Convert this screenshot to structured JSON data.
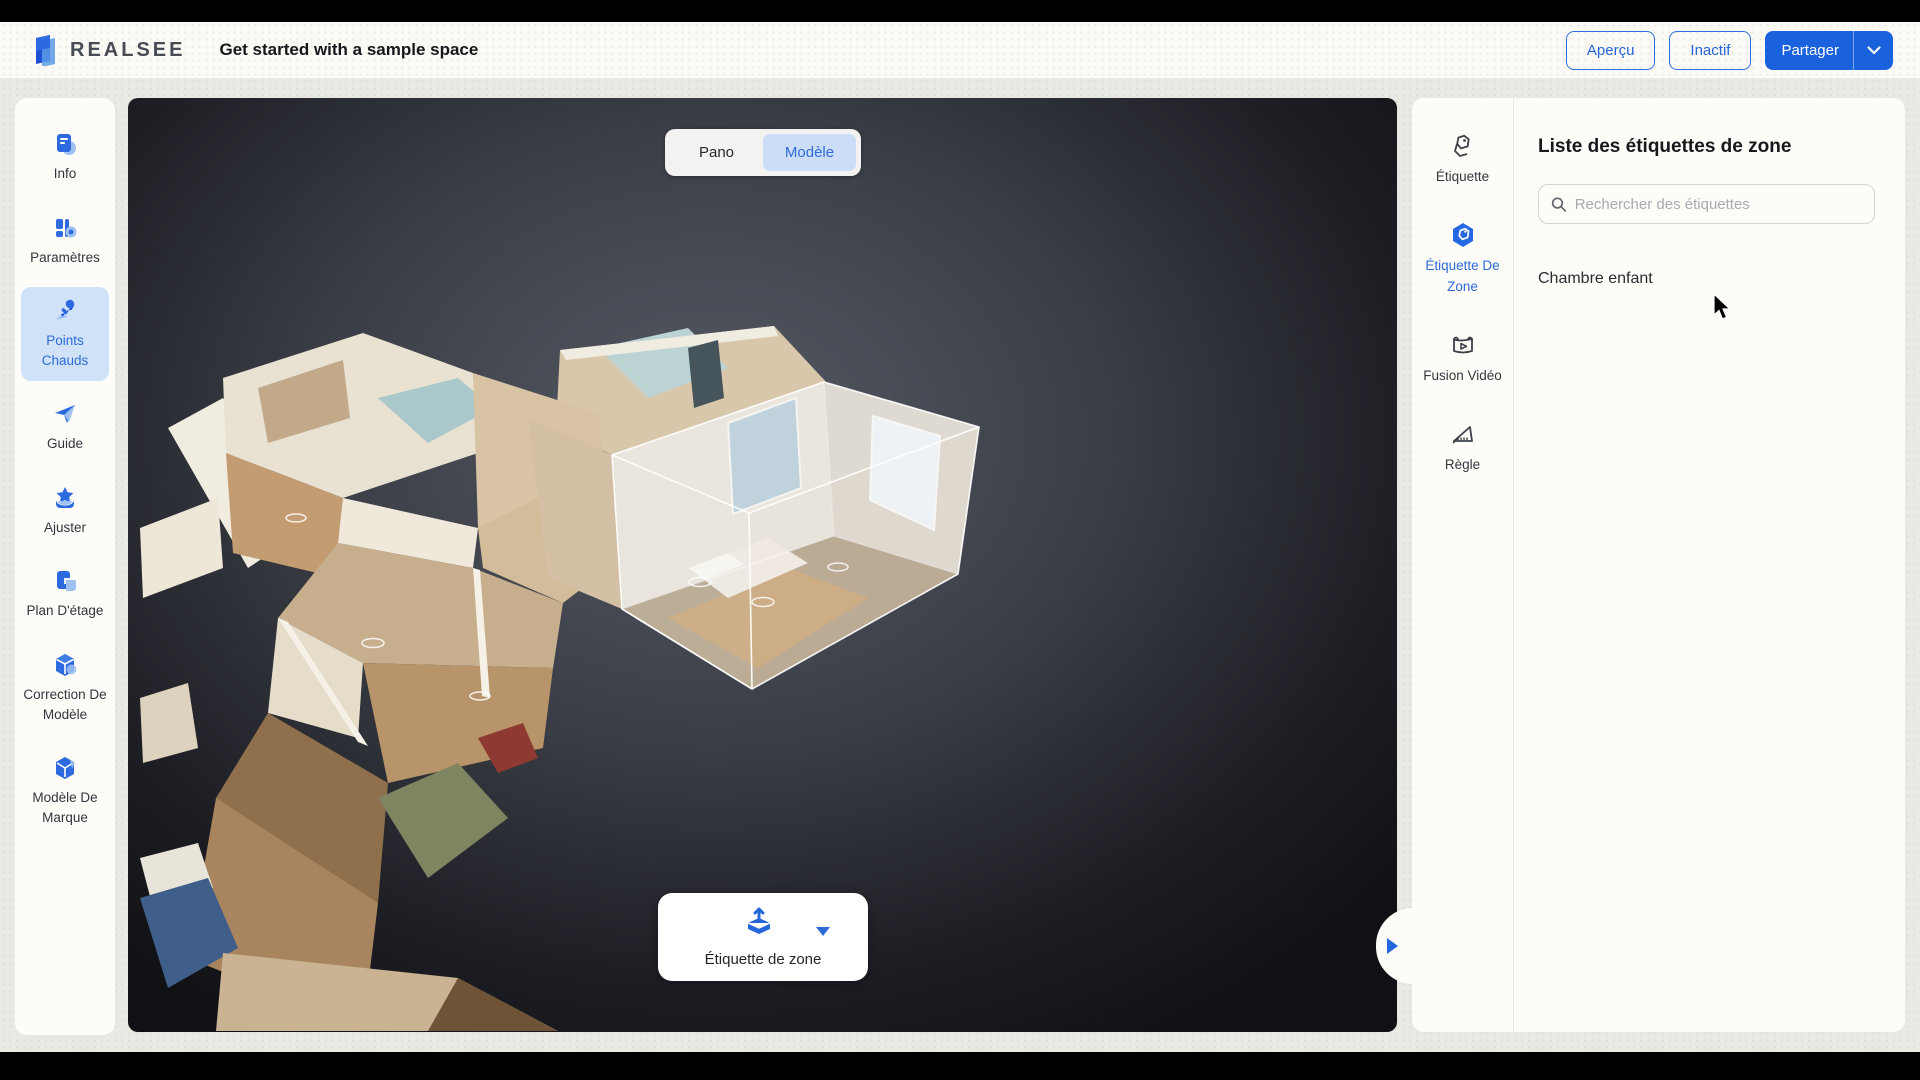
{
  "header": {
    "brand": "REALSEE",
    "title": "Get started with a sample space",
    "preview_label": "Aperçu",
    "inactive_label": "Inactif",
    "share_label": "Partager"
  },
  "sidebar": {
    "items": [
      {
        "label": "Info",
        "icon": "info-icon",
        "selected": false
      },
      {
        "label": "Paramètres",
        "icon": "settings-icon",
        "selected": false
      },
      {
        "label": "Points Chauds",
        "icon": "hotspot-pin-icon",
        "selected": true
      },
      {
        "label": "Guide",
        "icon": "guide-plane-icon",
        "selected": false
      },
      {
        "label": "Ajuster",
        "icon": "adjust-icon",
        "selected": false
      },
      {
        "label": "Plan D'étage",
        "icon": "floorplan-icon",
        "selected": false
      },
      {
        "label": "Correction De Modèle",
        "icon": "model-correction-icon",
        "selected": false
      },
      {
        "label": "Modèle De Marque",
        "icon": "brand-model-icon",
        "selected": false
      }
    ]
  },
  "viewport": {
    "mode_toggle": {
      "options": [
        "Pano",
        "Modèle"
      ],
      "selected": "Modèle"
    },
    "zone_tool_label": "Étiquette de zone"
  },
  "right_panel": {
    "tools": [
      {
        "label": "Étiquette",
        "icon": "tag-icon",
        "selected": false
      },
      {
        "label": "Étiquette De Zone",
        "icon": "zone-tag-icon",
        "selected": true
      },
      {
        "label": "Fusion Vidéo",
        "icon": "video-fusion-icon",
        "selected": false
      },
      {
        "label": "Règle",
        "icon": "ruler-icon",
        "selected": false
      }
    ],
    "list": {
      "title": "Liste des étiquettes de zone",
      "search_placeholder": "Rechercher des étiquettes",
      "items": [
        "Chambre enfant"
      ]
    }
  },
  "icons": {
    "share_caret": "chevron-down",
    "panel_handle": "triangle-right",
    "zone_tool_caret": "triangle-down",
    "search": "magnifier"
  },
  "colors": {
    "accent_blue": "#2566d8",
    "share_fill": "#1a62dd",
    "selected_item_bg": "#cfe2f8",
    "selected_text": "#2e6bd8",
    "panel_bg": "#fdfcf8",
    "viewport_dark": "#1d1e24",
    "top_bottom_bars": "#000000"
  }
}
